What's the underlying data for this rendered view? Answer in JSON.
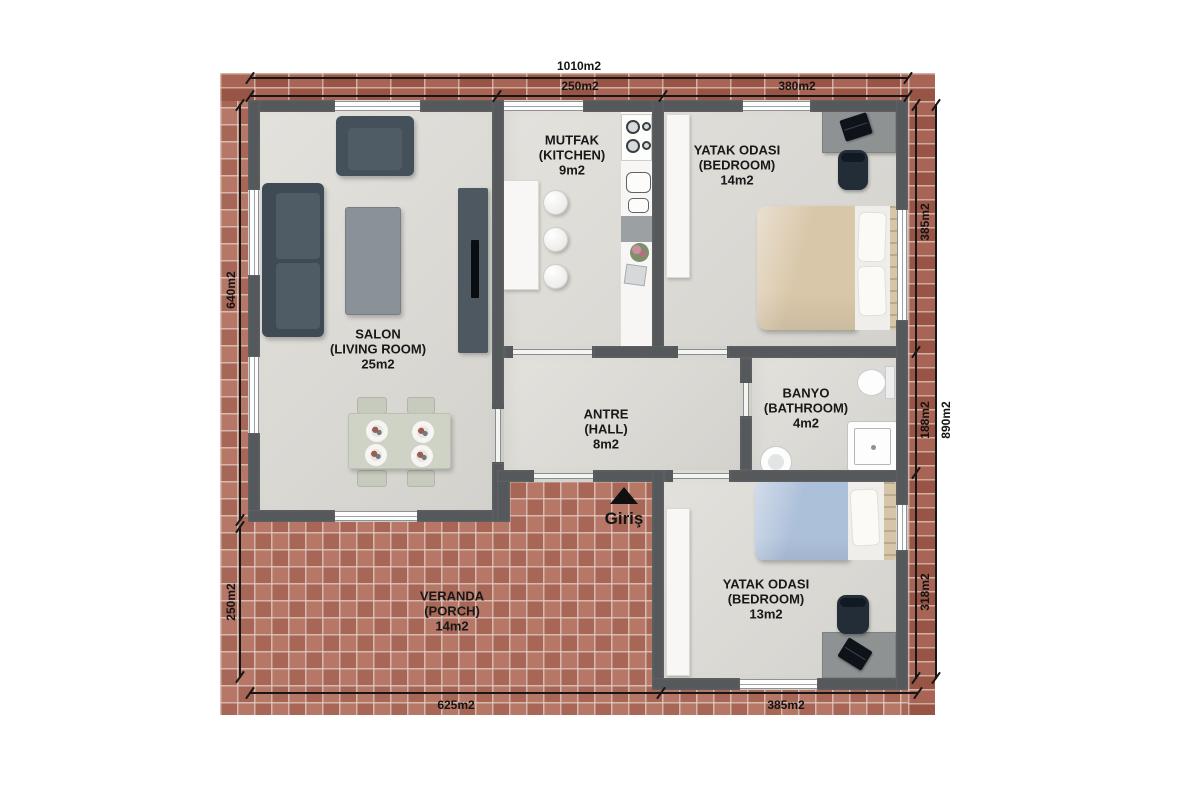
{
  "rooms": [
    {
      "id": "salon",
      "label_tr": "SALON",
      "label_en": "(LIVING ROOM)",
      "area": "25m2"
    },
    {
      "id": "kitchen",
      "label_tr": "MUTFAK",
      "label_en": "(KITCHEN)",
      "area": "9m2"
    },
    {
      "id": "bedroom1",
      "label_tr": "YATAK ODASI",
      "label_en": "(BEDROOM)",
      "area": "14m2"
    },
    {
      "id": "hall",
      "label_tr": "ANTRE",
      "label_en": "(HALL)",
      "area": "8m2"
    },
    {
      "id": "bathroom",
      "label_tr": "BANYO",
      "label_en": "(BATHROOM)",
      "area": "4m2"
    },
    {
      "id": "bedroom2",
      "label_tr": "YATAK ODASI",
      "label_en": "(BEDROOM)",
      "area": "13m2"
    },
    {
      "id": "veranda",
      "label_tr": "VERANDA",
      "label_en": "(PORCH)",
      "area": "14m2"
    }
  ],
  "entrance": {
    "label": "Giriş",
    "arrow_icon": "triangle-up"
  },
  "dimensions": {
    "top_total": "1010m2",
    "top_kitchen": "250m2",
    "top_bedroom1": "380m2",
    "left_main": "640m2",
    "left_veranda": "250m2",
    "right_bedroom1": "385m2",
    "right_bathroom": "188m2",
    "right_bedroom2": "318m2",
    "right_total": "890m2",
    "bottom_veranda": "625m2",
    "bottom_bedroom2": "385m2"
  },
  "colors": {
    "brick": "#b06c5c",
    "brick_border": "#a35b4a",
    "wall": "#56595b",
    "floor": "#dedcd7",
    "dark_furniture": "#44505a",
    "bed1_duvet": "#d9c7a9",
    "bed2_duvet": "#adc0da",
    "dining_table": "#ced3c5",
    "text": "#161616"
  }
}
